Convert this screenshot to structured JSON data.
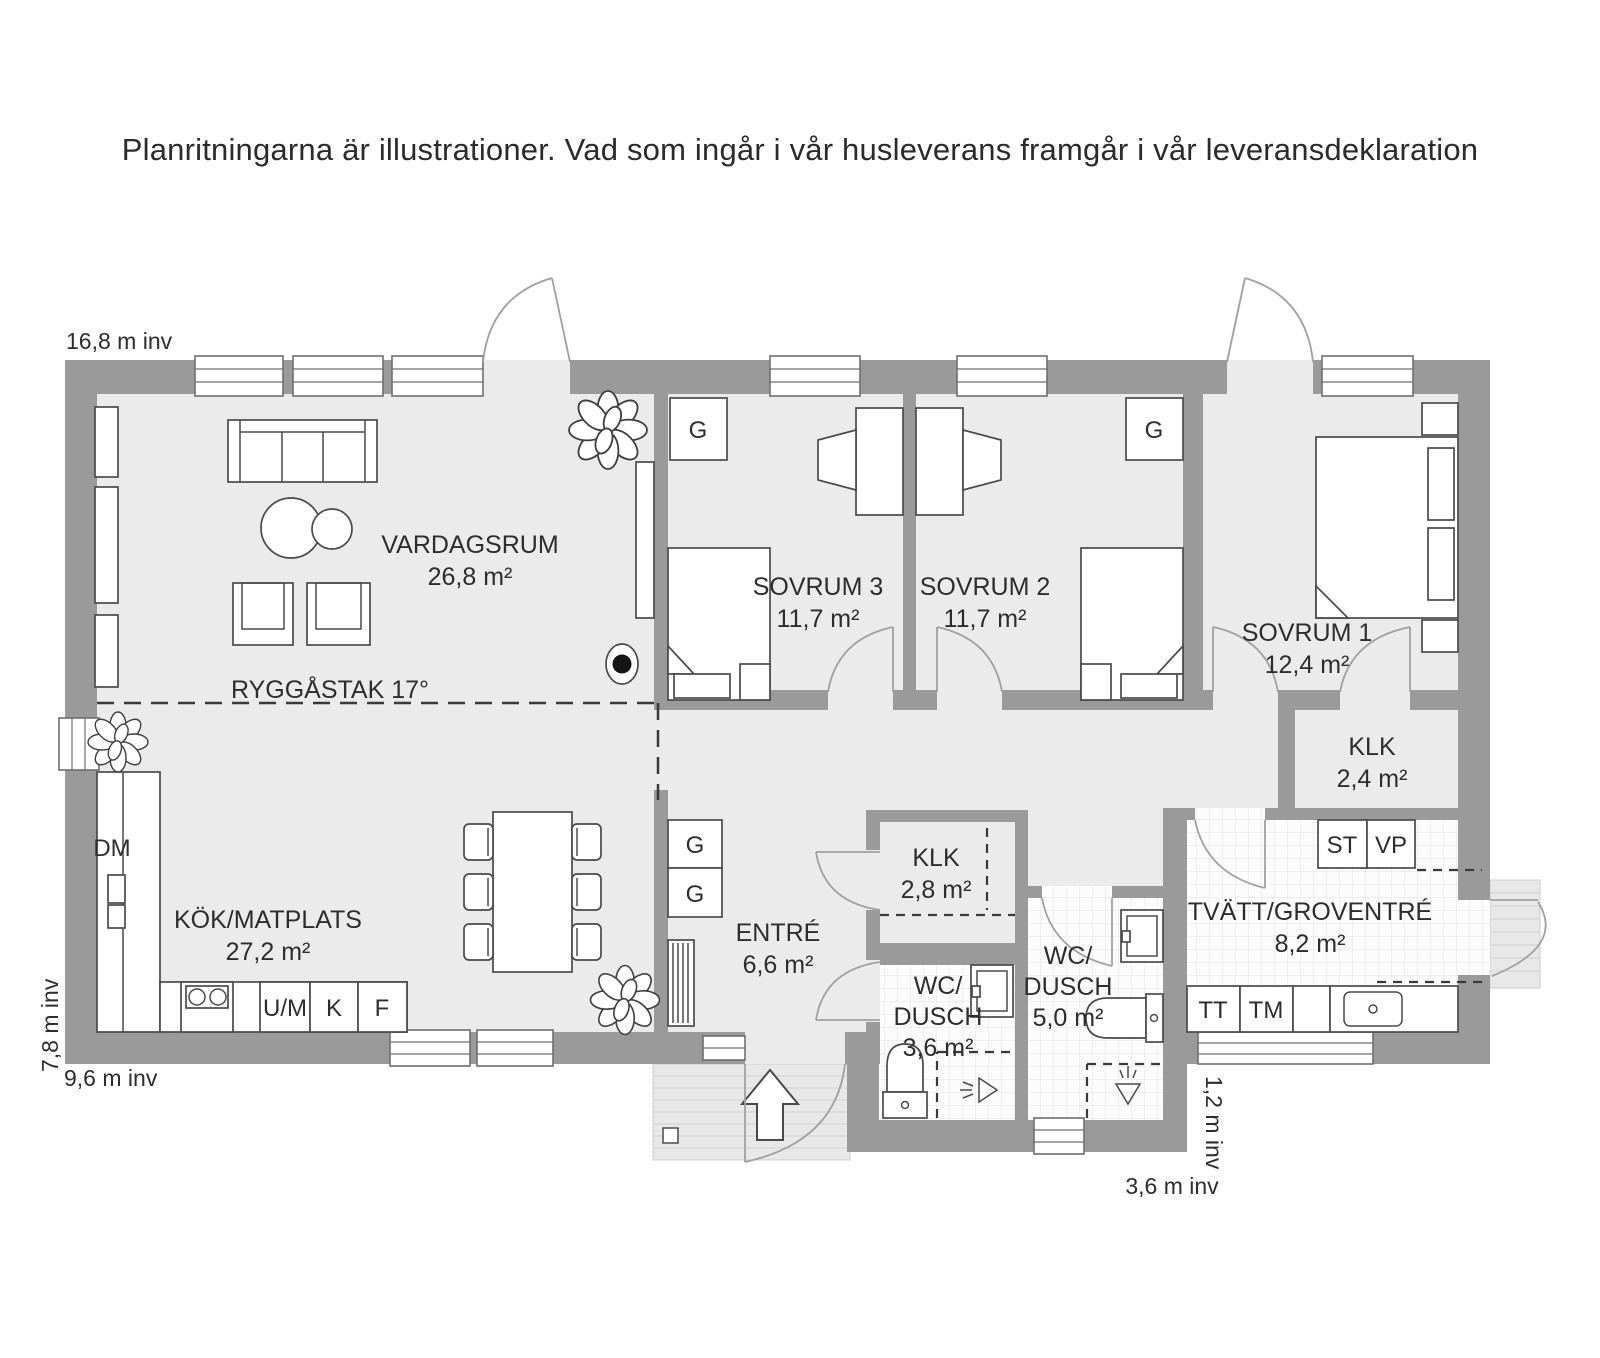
{
  "title": "Planritningarna är illustrationer. Vad som ingår i vår husleverans framgår i vår leveransdeklaration",
  "plan": {
    "ceiling_note": "RYGGÅSTAK 17°",
    "rooms": {
      "vardagsrum": {
        "name": "VARDAGSRUM",
        "area": "26,8 m²"
      },
      "sovrum3": {
        "name": "SOVRUM 3",
        "area": "11,7 m²"
      },
      "sovrum2": {
        "name": "SOVRUM 2",
        "area": "11,7 m²"
      },
      "sovrum1": {
        "name": "SOVRUM 1",
        "area": "12,4 m²"
      },
      "klk_sovrum1": {
        "name": "KLK",
        "area": "2,4 m²"
      },
      "kok": {
        "name": "KÖK/MATPLATS",
        "area": "27,2 m²"
      },
      "entre": {
        "name": "ENTRÉ",
        "area": "6,6 m²"
      },
      "klk_entre": {
        "name": "KLK",
        "area": "2,8 m²"
      },
      "wc_dusch_liten": {
        "name_line1": "WC/",
        "name_line2": "DUSCH",
        "area": "3,6 m²"
      },
      "wc_dusch_stor": {
        "name_line1": "WC/",
        "name_line2": "DUSCH",
        "area": "5,0 m²"
      },
      "tvatt": {
        "name": "TVÄTT/GROVENTRÉ",
        "area": "8,2 m²"
      }
    },
    "appliances": {
      "dm": "DM",
      "um": "U/M",
      "k": "K",
      "f": "F",
      "g": "G",
      "tt": "TT",
      "tm": "TM",
      "st": "ST",
      "vp": "VP"
    },
    "dimensions": {
      "top": "16,8 m inv",
      "left": "7,8 m inv",
      "bottom_left": "9,6 m inv",
      "bottom_middle": "3,6 m inv",
      "right": "1,2 m inv"
    },
    "colors": {
      "wall": "#9a9a9a",
      "floor": "#ebebeb",
      "wet_room_floor": "#fcfcfc",
      "deck": "#e8e8e8",
      "text": "#2d2d2d"
    }
  }
}
